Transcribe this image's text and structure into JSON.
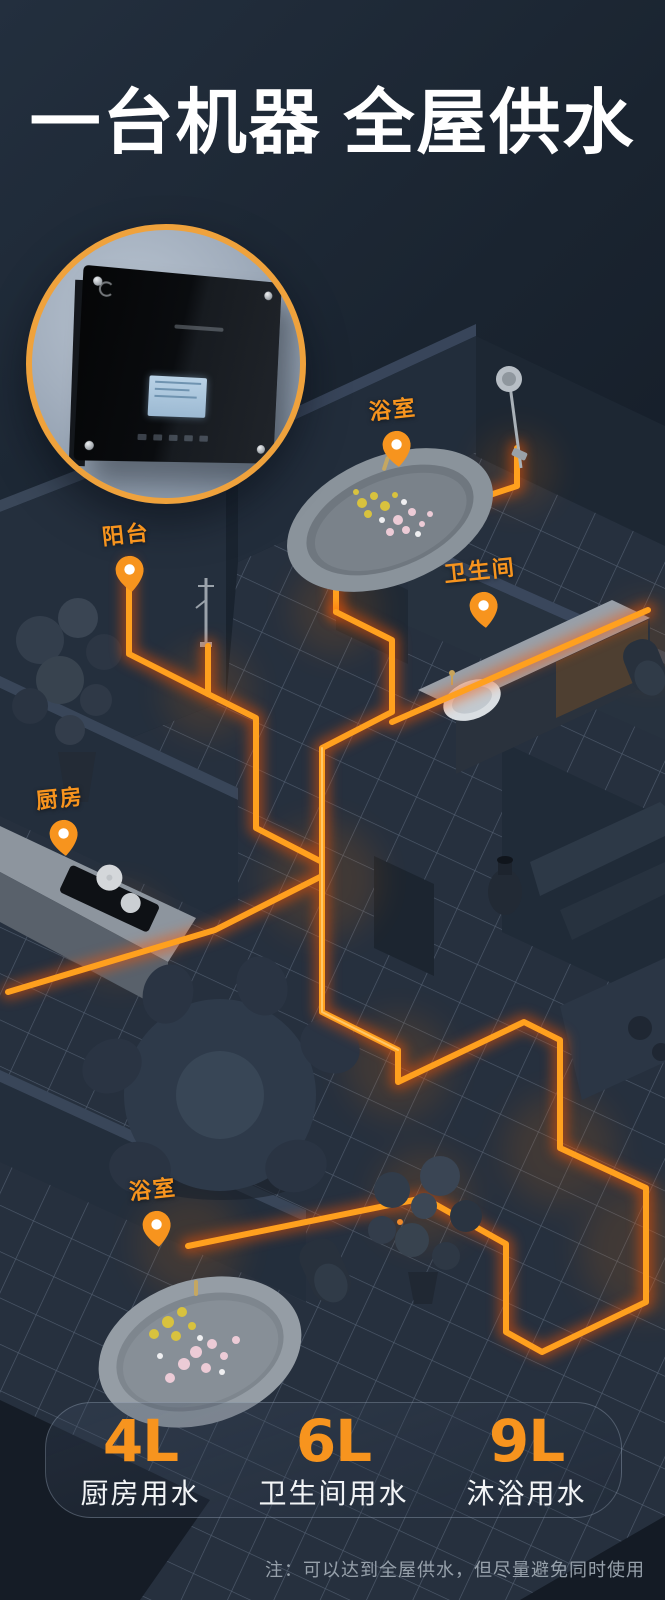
{
  "title": "一台机器 全屋供水",
  "pins": [
    {
      "id": "bathroom-top",
      "label": "浴室"
    },
    {
      "id": "balcony",
      "label": "阳台"
    },
    {
      "id": "toilet-room",
      "label": "卫生间"
    },
    {
      "id": "kitchen",
      "label": "厨房"
    },
    {
      "id": "bathroom-bottom",
      "label": "浴室"
    }
  ],
  "stats": [
    {
      "value": "4L",
      "label": "厨房用水"
    },
    {
      "value": "6L",
      "label": "卫生间用水"
    },
    {
      "value": "9L",
      "label": "沐浴用水"
    }
  ],
  "note": "注：可以达到全屋供水，但尽量避免同时使用",
  "colors": {
    "accent": "#F7941E",
    "pipe": "#FFA01E",
    "pipe_glow": "#FF5400",
    "circle_ring": "#EFA23C",
    "background": "#1A2430",
    "note_text": "#97A1AB"
  }
}
